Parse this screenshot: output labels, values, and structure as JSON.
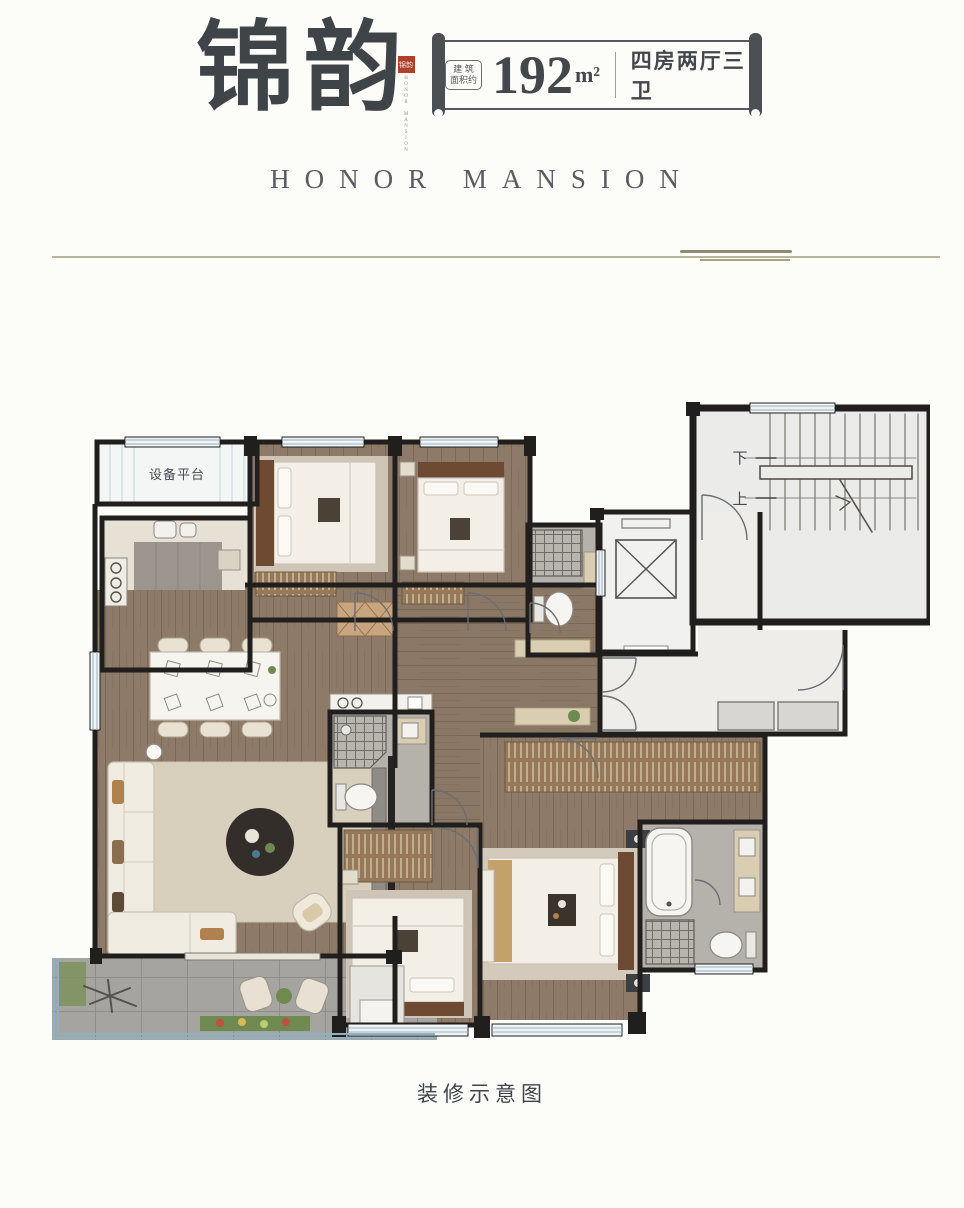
{
  "header": {
    "title": "锦韵",
    "seal": {
      "chars": "锦韵",
      "brand_vertical": "HONOR MANSION"
    },
    "banner": {
      "area_prefix_line1": "建 筑",
      "area_prefix_line2": "面积约",
      "area_value": "192",
      "area_unit": "m²",
      "spec": "四房两厅三卫"
    },
    "subtitle": "HONOR MANSION"
  },
  "floorplan": {
    "labels": {
      "equipment_platform": "设备平台",
      "stairs_down": "下",
      "stairs_up": "上"
    }
  },
  "footer": {
    "caption": "装修示意图"
  },
  "colors": {
    "seal_red": "#b0402c",
    "ink": "#3f4449",
    "scroll_dark": "#4b4f53",
    "divider_olive": "#b7b59a",
    "wall_black": "#211f1d",
    "wood_floor": "#8d7a68",
    "lobby_marble": "#efede9",
    "stone_gray": "#b5b1ab",
    "balcony_gray": "#a5a4a0",
    "rug_beige": "#d6ccbb",
    "window_blue": "#9fb2bf"
  }
}
